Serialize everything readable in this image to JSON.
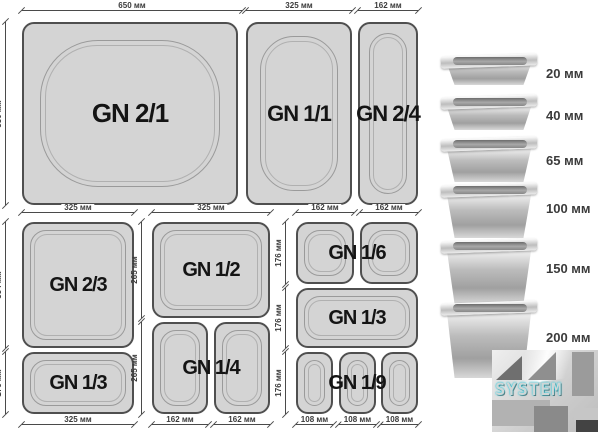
{
  "top_section": {
    "gn21": {
      "label": "GN 2/1",
      "top_dim": "650 мм",
      "left_dim": "530 мм"
    },
    "gn11": {
      "label": "GN 1/1",
      "top_dim": "325 мм"
    },
    "gn24": {
      "label": "GN 2/4",
      "top_dim": "162 мм"
    }
  },
  "bottom_left": {
    "top_dim": "325 мм",
    "bottom_dim": "325 мм",
    "gn23": {
      "label": "GN 2/3",
      "side_dim": "354 мм"
    },
    "gn13": {
      "label": "GN 1/3",
      "side_dim": "176 мм"
    }
  },
  "bottom_middle": {
    "top_dim": "325 мм",
    "gn12": {
      "label": "GN 1/2",
      "side_dim": "265 мм"
    },
    "gn14": {
      "label": "GN 1/4",
      "side_dim": "265 мм",
      "bottom_dims": [
        "162 мм",
        "162 мм"
      ]
    }
  },
  "bottom_right": {
    "top_dims": [
      "162 мм",
      "162 мм"
    ],
    "gn16": {
      "label": "GN 1/6",
      "side_dim": "176 мм"
    },
    "gn13": {
      "label": "GN 1/3",
      "side_dim": "176 мм"
    },
    "gn19": {
      "label": "GN 1/9",
      "side_dim": "176 мм",
      "bottom_dims": [
        "108 мм",
        "108 мм",
        "108 мм"
      ]
    }
  },
  "depth_column": {
    "items": [
      {
        "depth": "20 мм"
      },
      {
        "depth": "40 мм"
      },
      {
        "depth": "65 мм"
      },
      {
        "depth": "100 мм"
      },
      {
        "depth": "150 мм"
      },
      {
        "depth": "200 мм"
      }
    ]
  },
  "logo": {
    "text": "SYSTEM"
  },
  "colors": {
    "pan_fill": "#d4d4d4",
    "pan_border": "#4f4f4f",
    "dim_line": "#4a4a4a",
    "logo_glow": "#21c8dc",
    "background": "#ffffff"
  }
}
